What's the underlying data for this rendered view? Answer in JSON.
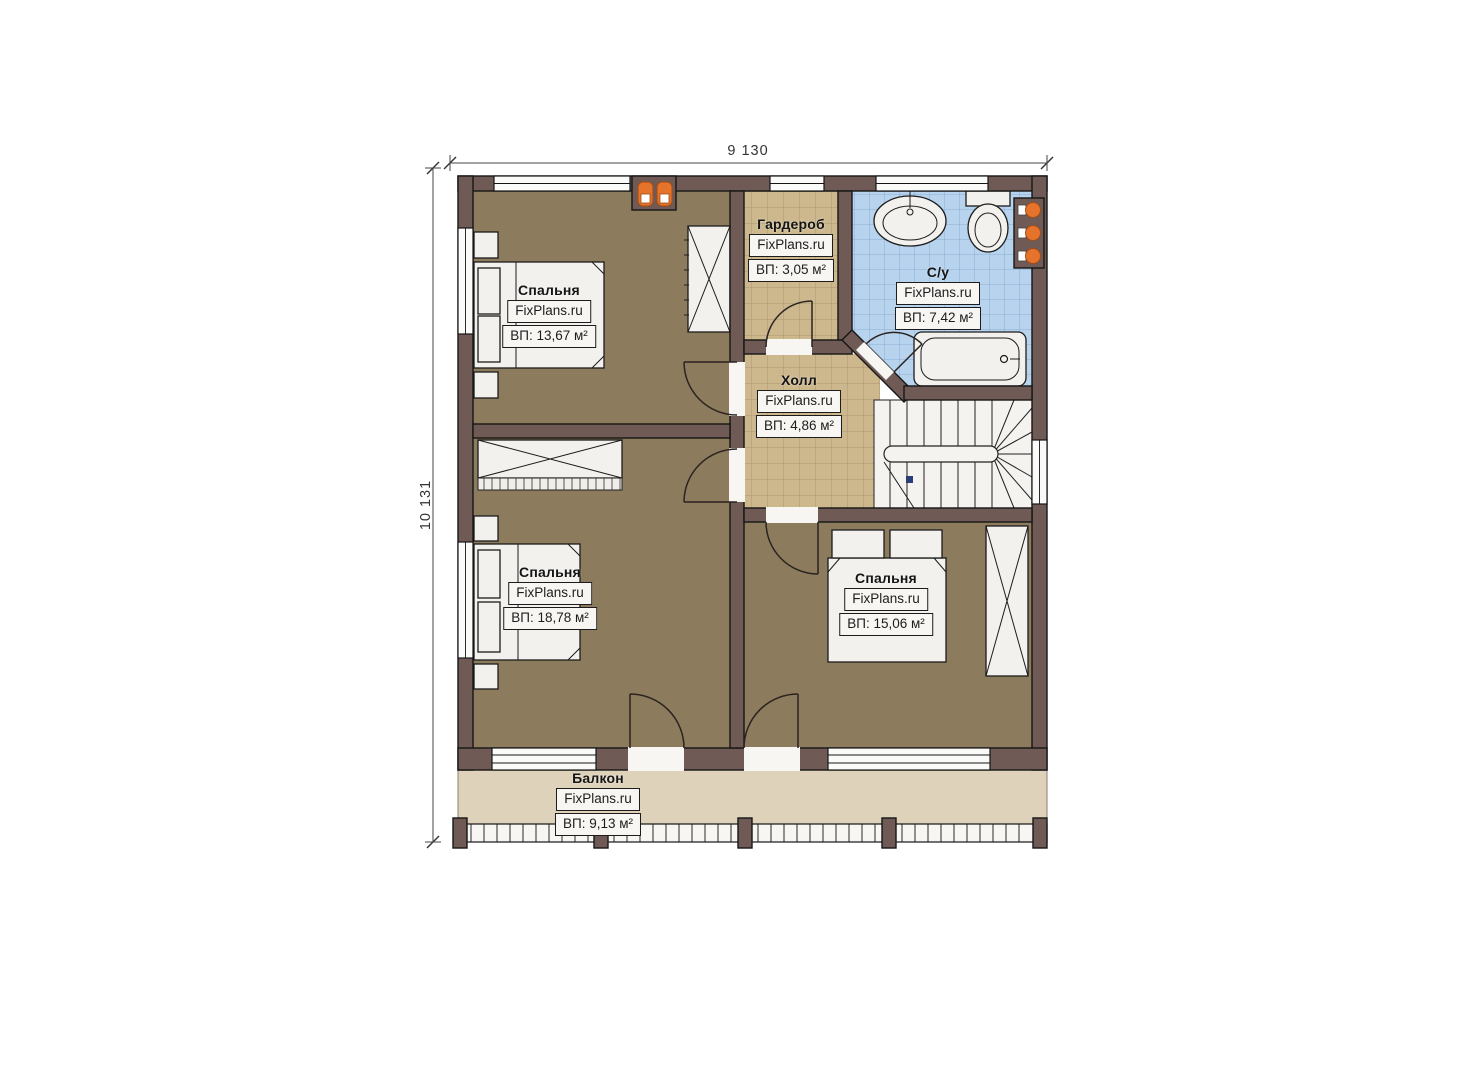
{
  "watermark": "FixPlans.ru",
  "dimensions": {
    "width_label": "9 130",
    "height_label": "10 131"
  },
  "rooms": [
    {
      "id": "bedroom-1",
      "name": "Спальня",
      "area_label": "ВП: 13,67 м²"
    },
    {
      "id": "wardrobe",
      "name": "Гардероб",
      "area_label": "ВП: 3,05 м²"
    },
    {
      "id": "bathroom",
      "name": "С/у",
      "area_label": "ВП: 7,42 м²"
    },
    {
      "id": "hall",
      "name": "Холл",
      "area_label": "ВП: 4,86 м²"
    },
    {
      "id": "bedroom-2",
      "name": "Спальня",
      "area_label": "ВП: 18,78 м²"
    },
    {
      "id": "bedroom-3",
      "name": "Спальня",
      "area_label": "ВП: 15,06 м²"
    },
    {
      "id": "balcony",
      "name": "Балкон",
      "area_label": "ВП: 9,13 м²"
    }
  ],
  "colors": {
    "wall": "#6f5a56",
    "bedroom_floor": "#8c7b5d",
    "tile_floor": "#cdb88e",
    "tile_line": "#8a744d",
    "bathroom_floor": "#b7d3ee",
    "bathroom_line": "#6f94bd",
    "balcony_floor": "#ded2ba",
    "radiator": "#e5732c"
  }
}
